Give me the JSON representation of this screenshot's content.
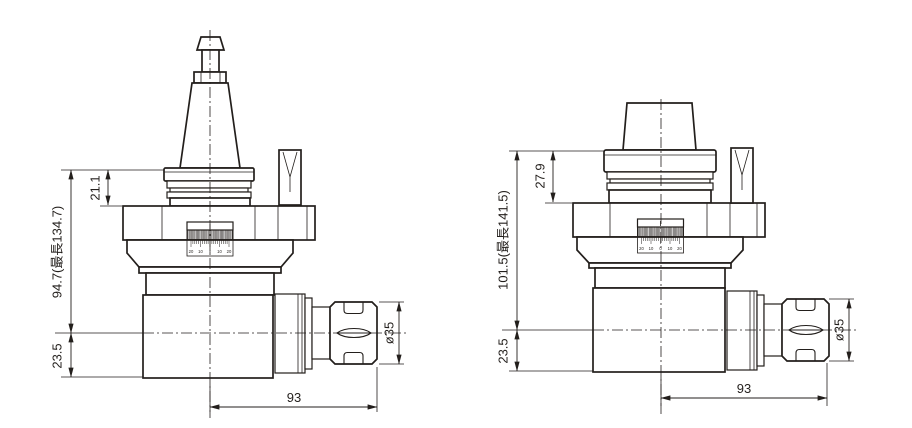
{
  "colors": {
    "line": "#231f1c",
    "background": "#ffffff"
  },
  "left_view": {
    "dims": {
      "upper": "21.1",
      "overall": "94.7(最長134.7)",
      "lower": "23.5",
      "length": "93",
      "diameter": "ø35"
    }
  },
  "right_view": {
    "dims": {
      "upper": "27.9",
      "overall": "101.5(最長141.5)",
      "lower": "23.5",
      "length": "93",
      "diameter": "ø35"
    }
  },
  "dial": {
    "scale_labels": [
      "20",
      "10",
      "0",
      "10",
      "20"
    ]
  }
}
